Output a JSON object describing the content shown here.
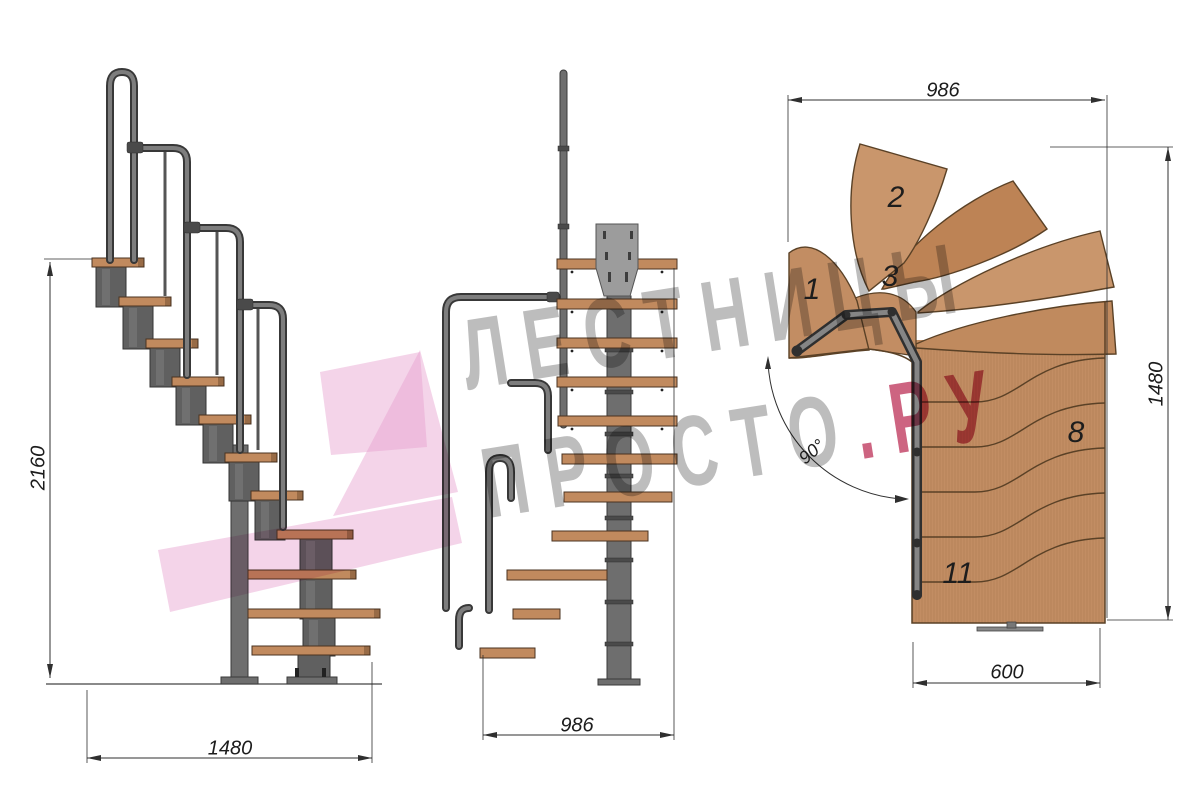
{
  "dimensions": {
    "side_height": "2160",
    "side_width": "1480",
    "front_width": "986",
    "plan_top_width": "986",
    "plan_height": "1480",
    "plan_bottom_width": "600",
    "plan_turn_angle": "90°"
  },
  "plan_step_labels": {
    "s1": "1",
    "s2": "2",
    "s3": "3",
    "s8": "8",
    "s11": "11"
  },
  "watermark": {
    "line1": "ЛЕСТНИЦЫ",
    "line2_gray": "ПРОСТО",
    "line2_pink": ".РУ"
  },
  "colors": {
    "background": "#ffffff",
    "wood": "#c28d63",
    "wood_outline": "#5a4126",
    "metal": "#606060",
    "metal_dark": "#383838",
    "dimension_lines": "#2f2f2f",
    "watermark_gray": "#919191",
    "watermark_pink": "#c04e6e",
    "ribbon_pink": "#e79fce"
  }
}
